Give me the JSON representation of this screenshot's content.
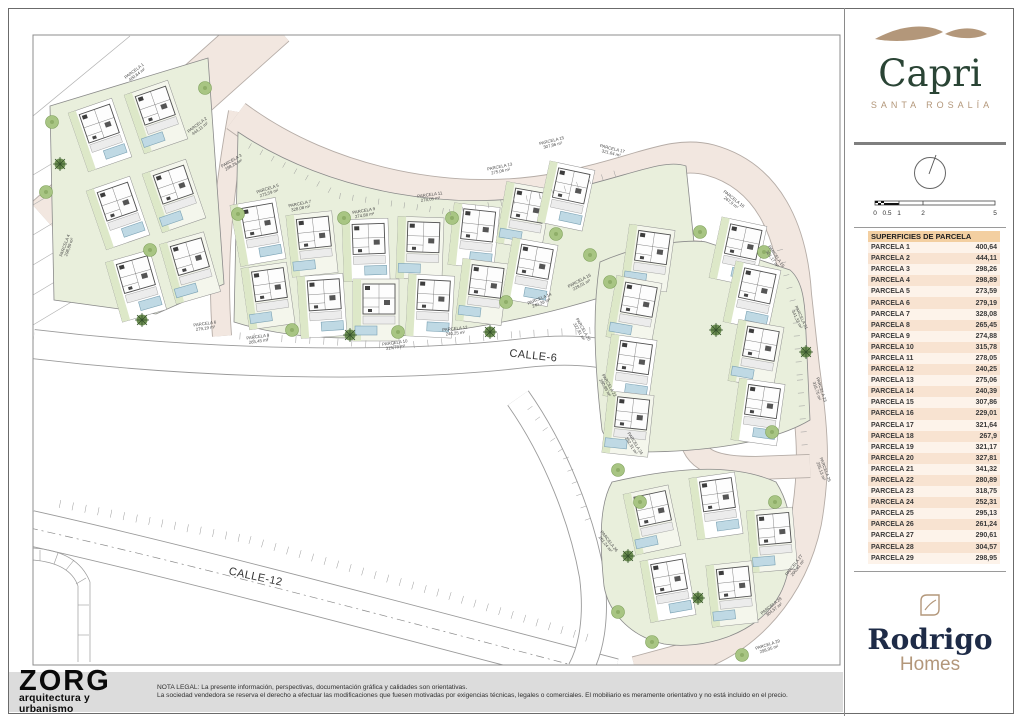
{
  "header": {
    "project": "Capri",
    "project_subtitle": "SANTA ROSALÍA"
  },
  "sidebar": {
    "table_title": "SUPERFICIES DE PARCELA",
    "scale_labels": [
      "0",
      "0.5",
      "1",
      "2",
      "5"
    ],
    "parcels": [
      {
        "label": "PARCELA 1",
        "value": "400,64"
      },
      {
        "label": "PARCELA 2",
        "value": "444,11"
      },
      {
        "label": "PARCELA 3",
        "value": "298,26"
      },
      {
        "label": "PARCELA 4",
        "value": "298,89"
      },
      {
        "label": "PARCELA 5",
        "value": "273,59"
      },
      {
        "label": "PARCELA 6",
        "value": "279,19"
      },
      {
        "label": "PARCELA 7",
        "value": "328,08"
      },
      {
        "label": "PARCELA 8",
        "value": "265,45"
      },
      {
        "label": "PARCELA 9",
        "value": "274,88"
      },
      {
        "label": "PARCELA 10",
        "value": "315,78"
      },
      {
        "label": "PARCELA 11",
        "value": "278,05"
      },
      {
        "label": "PARCELA 12",
        "value": "240,25"
      },
      {
        "label": "PARCELA 13",
        "value": "275,06"
      },
      {
        "label": "PARCELA 14",
        "value": "240,39"
      },
      {
        "label": "PARCELA 15",
        "value": "307,86"
      },
      {
        "label": "PARCELA 16",
        "value": "229,01"
      },
      {
        "label": "PARCELA 17",
        "value": "321,64"
      },
      {
        "label": "PARCELA 18",
        "value": "267,9"
      },
      {
        "label": "PARCELA 19",
        "value": "321,17"
      },
      {
        "label": "PARCELA 20",
        "value": "327,81"
      },
      {
        "label": "PARCELA 21",
        "value": "341,32"
      },
      {
        "label": "PARCELA 22",
        "value": "280,89"
      },
      {
        "label": "PARCELA 23",
        "value": "318,75"
      },
      {
        "label": "PARCELA 24",
        "value": "252,31"
      },
      {
        "label": "PARCELA 25",
        "value": "295,13"
      },
      {
        "label": "PARCELA 26",
        "value": "261,24"
      },
      {
        "label": "PARCELA 27",
        "value": "290,61"
      },
      {
        "label": "PARCELA 28",
        "value": "304,57"
      },
      {
        "label": "PARCELA 29",
        "value": "298,95"
      }
    ],
    "developer": {
      "name": "Rodrigo",
      "sub": "Homes"
    }
  },
  "map": {
    "streets": [
      "CALLE-6",
      "CALLE-12"
    ],
    "area_unit": "m²"
  },
  "footer": {
    "studio": "ZORG",
    "studio_sub": "arquitectura y urbanismo",
    "legal_line1": "NOTA LEGAL: La presente información, perspectivas, documentación gráfica y calidades son orientativas.",
    "legal_line2": "La sociedad vendedora se reserva el derecho a efectuar las modificaciones que fuesen motivadas por exigencias técnicas, legales o comerciales. El mobiliario es meramente orientativo y no está incluido en el precio."
  },
  "colors": {
    "brand_tan": "#b3977a",
    "brand_green": "#2a4435",
    "brand_navy": "#1e2b47",
    "road_pink": "#f2e7e0",
    "garden_green": "#e9efdc",
    "pool_blue": "#bfd9e4",
    "table_header_bg": "#f3cfa1",
    "table_row_a": "#fdf3ea",
    "table_row_b": "#f8e3d1"
  }
}
